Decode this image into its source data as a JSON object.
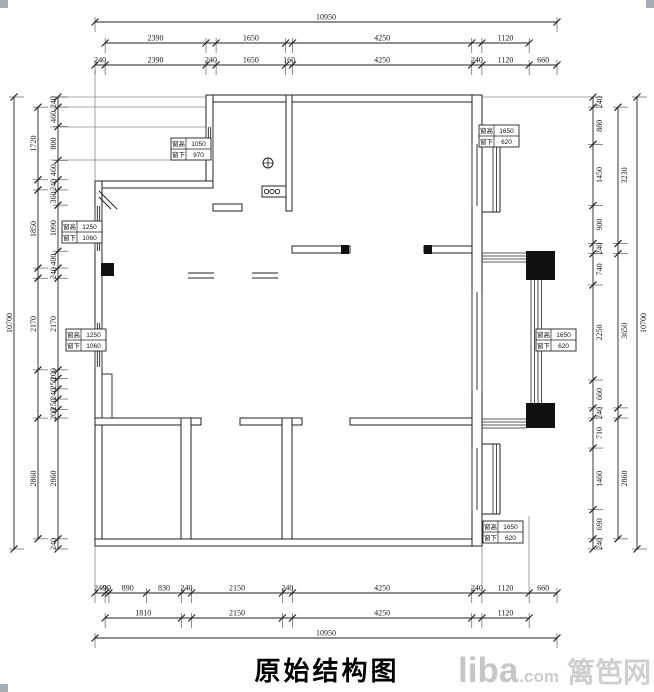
{
  "title": "原始结构图",
  "watermark": {
    "brand": "liba",
    "suffix": ".com",
    "cn": "篱笆网"
  },
  "dims": {
    "top": {
      "overall": {
        "offset": 0,
        "segs": [
          10950
        ],
        "text": [
          "10950"
        ]
      },
      "mid": {
        "offset": 240,
        "segs": [
          2390,
          240,
          1650,
          160,
          4250,
          240,
          1120
        ],
        "text": [
          "2390",
          "",
          "1650",
          "",
          "4250",
          "",
          "1120"
        ]
      },
      "detail": {
        "offset": 0,
        "segs": [
          240,
          2390,
          240,
          1650,
          160,
          4250,
          240,
          1120,
          660
        ],
        "text": [
          "240",
          "2390",
          "240",
          "1650",
          "160",
          "4250",
          "240",
          "1120",
          "660"
        ]
      }
    },
    "bottom": {
      "detail": {
        "offset": 0,
        "segs": [
          240,
          90,
          890,
          830,
          240,
          2150,
          240,
          4250,
          240,
          1120,
          660
        ],
        "text": [
          "240",
          "90",
          "890",
          "830",
          "240",
          "2150",
          "240",
          "4250",
          "240",
          "1120",
          "660"
        ]
      },
      "mid": {
        "offset": 240,
        "segs": [
          1810,
          240,
          2150,
          240,
          4250,
          240,
          1120
        ],
        "text": [
          "1810",
          "",
          "2150",
          "",
          "4250",
          "",
          "1120"
        ]
      },
      "overall": {
        "offset": 0,
        "segs": [
          10950
        ],
        "text": [
          "10950"
        ]
      }
    },
    "left": {
      "overall": {
        "offset": 0,
        "segs": [
          10700
        ],
        "text": [
          "10700"
        ]
      },
      "mid": {
        "offset": 240,
        "segs": [
          1720,
          240,
          1850,
          240,
          2170,
          1140,
          2860
        ],
        "text": [
          "1720",
          "",
          "1850",
          "",
          "2170",
          "",
          "2860"
        ]
      },
      "detail": {
        "offset": 0,
        "segs": [
          240,
          460,
          800,
          460,
          240,
          360,
          1090,
          400,
          240,
          2170,
          200,
          250,
          240,
          250,
          200,
          2860,
          240
        ],
        "text": [
          "240",
          "460",
          "800",
          "460",
          "240",
          "360",
          "1090",
          "400",
          "240",
          "2170",
          "200",
          "250",
          "240",
          "250",
          "200",
          "2860",
          "240"
        ]
      }
    },
    "right": {
      "detail": {
        "offset": 0,
        "segs": [
          240,
          880,
          1450,
          900,
          240,
          740,
          2250,
          660,
          240,
          710,
          1460,
          690,
          240
        ],
        "text": [
          "240",
          "880",
          "1450",
          "900",
          "240",
          "740",
          "2250",
          "660",
          "240",
          "710",
          "1460",
          "690",
          "240"
        ]
      },
      "mid": {
        "offset": 240,
        "segs": [
          3230,
          240,
          3650,
          240,
          2860
        ],
        "text": [
          "3230",
          "",
          "3650",
          "",
          "2860"
        ]
      },
      "overall": {
        "offset": 0,
        "segs": [
          10700
        ],
        "text": [
          "10700"
        ]
      }
    }
  },
  "window_labels": [
    {
      "row1_label": "窗高",
      "row1_value": "1050",
      "row2_label": "窗下",
      "row2_value": "970"
    },
    {
      "row1_label": "窗高",
      "row1_value": "1650",
      "row2_label": "窗下",
      "row2_value": "620"
    },
    {
      "row1_label": "窗高",
      "row1_value": "1250",
      "row2_label": "窗下",
      "row2_value": "1060"
    },
    {
      "row1_label": "窗高",
      "row1_value": "1250",
      "row2_label": "窗下",
      "row2_value": "1060"
    },
    {
      "row1_label": "窗高",
      "row1_value": "1650",
      "row2_label": "窗下",
      "row2_value": "620"
    },
    {
      "row1_label": "窗高",
      "row1_value": "1650",
      "row2_label": "窗下",
      "row2_value": "620"
    }
  ]
}
